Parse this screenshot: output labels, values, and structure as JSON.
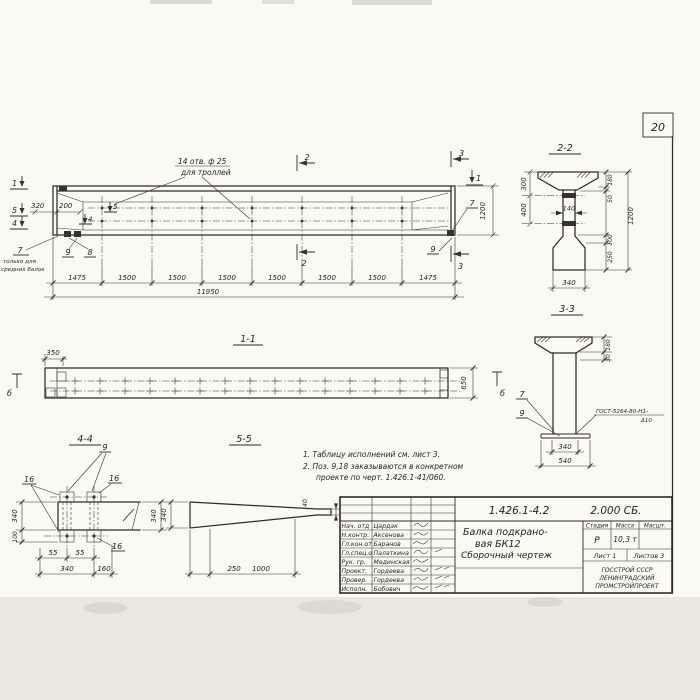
{
  "page": {
    "sheet_number": "20"
  },
  "main_view": {
    "holes_label_line1": "14 отв. ф 25",
    "holes_label_line2": "для троллей",
    "dim_320": "320",
    "dim_200": "200",
    "dim_1200": "1200",
    "dim_total": "11950",
    "segments": [
      "1475",
      "1500",
      "1500",
      "1500",
      "1500",
      "1500",
      "1500",
      "1475"
    ],
    "section_marks": {
      "m1": "1",
      "m2": "2",
      "m3": "3",
      "m4": "4",
      "m5": "5"
    },
    "callouts": {
      "c7": "7",
      "c8": "8",
      "c9": "9"
    },
    "footnote_line1": "только для",
    "footnote_line2": "средних балок"
  },
  "section_2_2": {
    "title": "2-2",
    "dim_300": "300",
    "dim_400": "400",
    "dim_140": "140",
    "dim_180": "180",
    "dim_50": "50",
    "dim_100": "100",
    "dim_250": "250",
    "dim_1200": "1200",
    "dim_340": "340"
  },
  "section_3_3": {
    "title": "3-3",
    "dim_180": "180",
    "dim_30": "30",
    "dim_340": "340",
    "dim_540": "540",
    "callout_7": "7",
    "callout_9": "9",
    "weld_note_line1": "ГОСТ-5264-80-Н1-",
    "weld_note_line2": "Δ10"
  },
  "section_1_1": {
    "title": "1-1",
    "dim_350": "350",
    "dim_650": "650",
    "mark_b_left": "б",
    "mark_b_right": "б"
  },
  "section_4_4": {
    "title": "4-4",
    "callout_9": "9",
    "callout_16_left": "16",
    "callout_16_right": "16",
    "callout_16_bottom": "16",
    "dim_55_a": "55",
    "dim_55_b": "55",
    "dim_340_bottom": "340",
    "dim_160": "160",
    "dim_340_left": "340",
    "dim_100_left": "100",
    "dim_340_right": "340"
  },
  "section_5_5": {
    "title": "5-5",
    "dim_340": "340",
    "dim_250": "250",
    "dim_1000": "1000",
    "dim_40": "40"
  },
  "notes": {
    "line1": "1. Таблицу исполнений см. лист 3.",
    "line2": "2. Поз. 9,18 заказываются в конкретном",
    "line3": "проекте по черт. 1.426.1-41/060."
  },
  "title_block": {
    "doc_number": "1.426.1-4.2",
    "doc_code": "2.000 СБ.",
    "title_line1": "Балка подкрано-",
    "title_line2": "вая БК12",
    "title_line3": "Сборочный чертеж",
    "stage_header": "Стадия",
    "mass_header": "Масса",
    "scale_header": "Масшт.",
    "stage_value": "Р",
    "mass_value": "10,3 т",
    "sheet_info": "Лист 1",
    "sheets_info": "Листов 3",
    "org_line1": "ГОССТРОЙ СССР",
    "org_line2": "ЛЕНИНГРАДСКИЙ",
    "org_line3": "ПРОМСТРОЙПРОЕКТ",
    "staff": [
      {
        "role": "Нач. отд",
        "name": "Цардак"
      },
      {
        "role": "Н.контр.",
        "name": "Аксенова"
      },
      {
        "role": "Гл.кон.от",
        "name": "Баранов"
      },
      {
        "role": "Гл.спец.о",
        "name": "Палаткина"
      },
      {
        "role": "Рук. гр.",
        "name": "Мединская"
      },
      {
        "role": "Проект.",
        "name": "Гордеева"
      },
      {
        "role": "Провер.",
        "name": "Гордеева"
      },
      {
        "role": "Исполн.",
        "name": "Бобович"
      }
    ]
  }
}
